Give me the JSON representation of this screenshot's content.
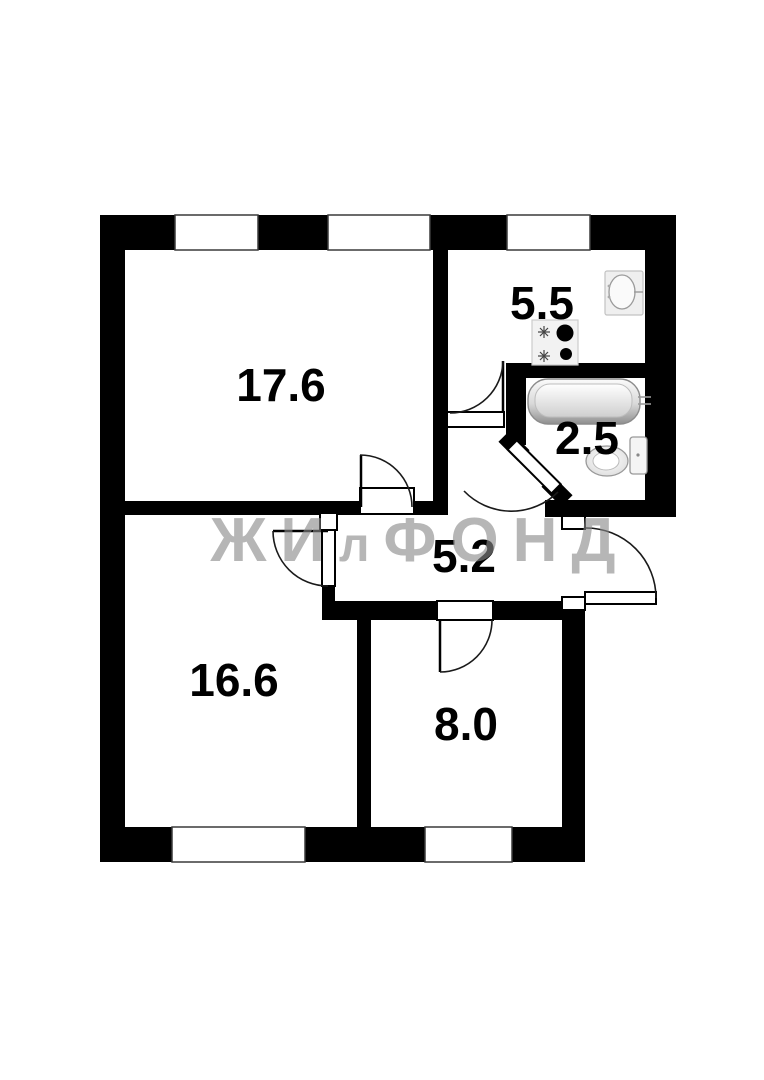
{
  "floorplan": {
    "type": "apartment-plan",
    "watermark": {
      "part1": "ЖИ",
      "part2": "л",
      "part3": "ФОНД"
    },
    "rooms": [
      {
        "name": "living-room",
        "area": "17.6"
      },
      {
        "name": "kitchen",
        "area": "5.5"
      },
      {
        "name": "bathroom",
        "area": "2.5"
      },
      {
        "name": "hallway",
        "area": "5.2"
      },
      {
        "name": "bedroom",
        "area": "16.6"
      },
      {
        "name": "small-room",
        "area": "8.0"
      }
    ],
    "fixtures": [
      "kitchen-sink",
      "stove",
      "bathtub",
      "toilet"
    ],
    "colors": {
      "wall": "#000000",
      "background": "#ffffff",
      "watermark": "#8a8a8a",
      "label": "#000000"
    }
  }
}
